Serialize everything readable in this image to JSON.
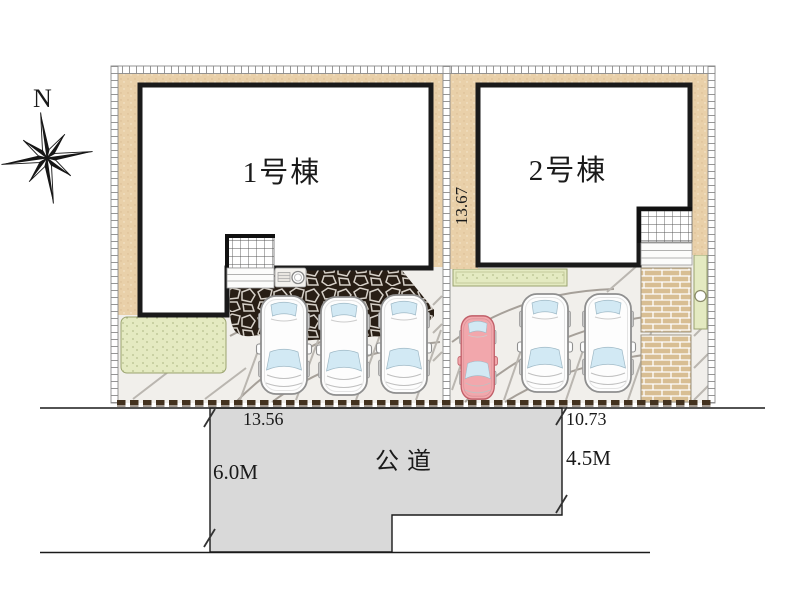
{
  "colors": {
    "tan": "#e9d0a9",
    "lawn_green": "#e4eac1",
    "brick": "#d8be93",
    "cobble": "#281e15",
    "road_gray": "#d9d9d9",
    "ground": "#f1efeb",
    "car_white": "#fdfdfd",
    "car_pink": "#f2a7ac",
    "glass_blue": "#d2e9f4",
    "outline": "#1a1a1a"
  },
  "plan": {
    "compass_label": "N",
    "buildings": [
      {
        "label": "1号棟"
      },
      {
        "label": "2号棟"
      }
    ],
    "dimensions": {
      "site_depth": "13.67",
      "frontage_left": "13.56",
      "frontage_right": "10.73"
    },
    "road": {
      "label": "公道",
      "width_left": "6.0M",
      "width_right": "4.5M"
    }
  }
}
